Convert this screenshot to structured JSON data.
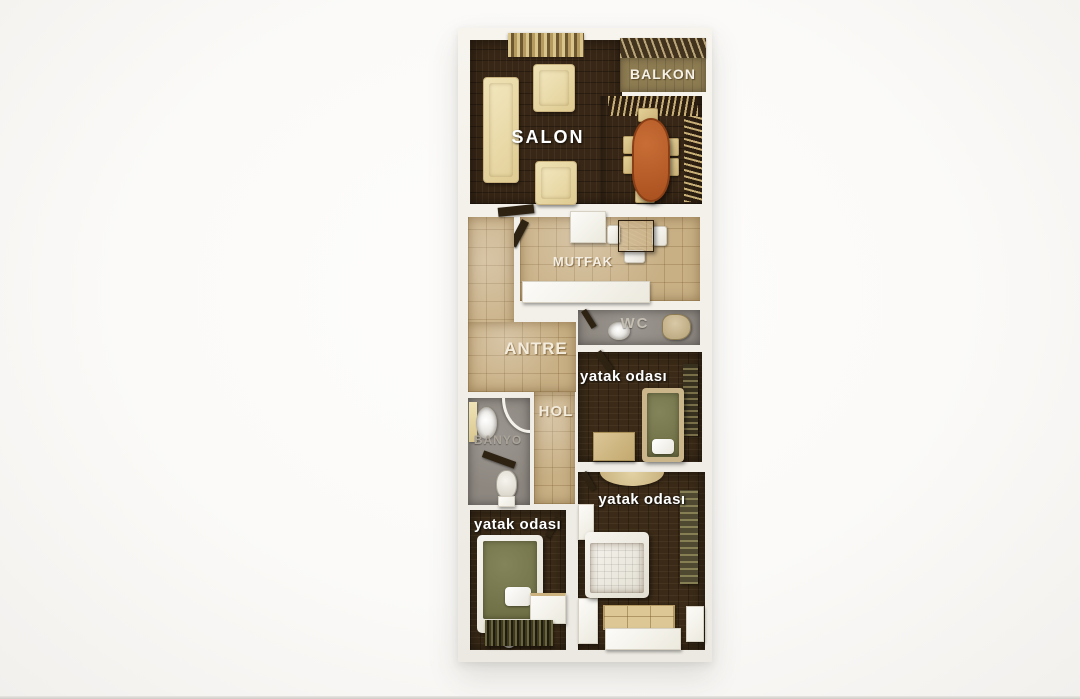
{
  "scene": {
    "type": "3d-apartment-floor-plan-render",
    "view": "top-down",
    "language": "Turkish"
  },
  "rooms": {
    "salon": {
      "label": "SALON",
      "floor": "dark wood",
      "furniture": [
        "sofa",
        "two armchairs",
        "oval dining table",
        "six dining chairs",
        "window curtains"
      ]
    },
    "balkon": {
      "label": "BALKON",
      "floor": "olive tile",
      "furniture": [
        "railing"
      ]
    },
    "mutfak": {
      "label": "MUTFAK",
      "floor": "beige tile",
      "furniture": [
        "counters",
        "wood table",
        "three chairs",
        "door"
      ]
    },
    "antre": {
      "label": "ANTRE",
      "floor": "beige tile",
      "furniture": [
        "entry door"
      ]
    },
    "wc": {
      "label": "WC",
      "floor": "gray",
      "furniture": [
        "sink",
        "toilet",
        "door"
      ]
    },
    "hol": {
      "label": "HOL",
      "floor": "beige tile",
      "furniture": []
    },
    "banyo": {
      "label": "BANYO",
      "floor": "gray",
      "furniture": [
        "sink cabinet",
        "shower",
        "toilet",
        "bench"
      ]
    },
    "bedroom_1": {
      "label": "yatak odası",
      "floor": "dark wood",
      "furniture": [
        "single bed (olive cover)",
        "dresser",
        "wardrobe",
        "door"
      ]
    },
    "bedroom_2": {
      "label": "yatak odası",
      "floor": "dark wood",
      "furniture": [
        "double bed (orange cover)",
        "wardrobe",
        "quilted chest",
        "nightstands",
        "arc rug",
        "door"
      ]
    },
    "bedroom_3": {
      "label": "yatak odası",
      "floor": "dark wood",
      "furniture": [
        "single bed (olive cover)",
        "desk",
        "striped rug",
        "door"
      ]
    }
  },
  "colors": {
    "background": "#fbfaf8",
    "walls": "#f3f0ea",
    "wood_floor": "#382716",
    "tile_floor": "#c8af84",
    "balcony_floor": "#8d7b51",
    "bathroom_floor": "#8d8780",
    "sofa_cream": "#e7d8a5",
    "dining_table_orange": "#b2591f",
    "bed_cover_olive": "#6b6c41",
    "bed_cover_orange": "#b36e0e",
    "label_white": "#ffffff",
    "label_gray": "#aba49a"
  }
}
